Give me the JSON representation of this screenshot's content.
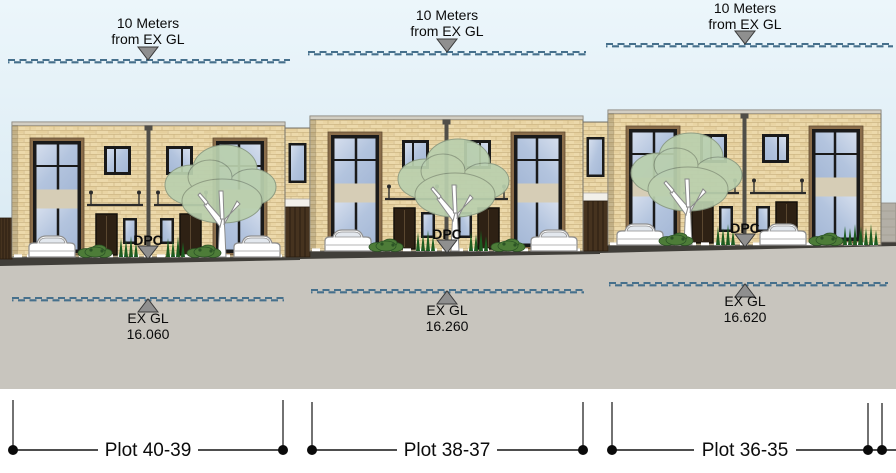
{
  "drawing": {
    "type": "street-elevation",
    "datum_label": {
      "line1": "10 Meters",
      "line2": "from EX GL"
    },
    "sections": [
      {
        "plot_label": "Plot 40-39",
        "dpc_label": "DPC",
        "exgl_label": "EX GL",
        "exgl_value": "16.060"
      },
      {
        "plot_label": "Plot 38-37",
        "dpc_label": "DPC",
        "exgl_label": "EX GL",
        "exgl_value": "16.260"
      },
      {
        "plot_label": "Plot 36-35",
        "dpc_label": "DPC",
        "exgl_label": "EX GL",
        "exgl_value": "16.620"
      }
    ],
    "icons": {
      "datum_marker": "triangle-down",
      "dpc_marker": "triangle-down",
      "level_marker": "triangle-up",
      "dimension_end": "filled-circle"
    },
    "colors": {
      "sky": "#e7f3fa",
      "ground": "#c8c5be",
      "road_strip": "#403e39",
      "brick": "#ecd9ab",
      "dashed_line": "#46708c",
      "foliage": "#bad0ae",
      "wood_fence": "#46331f",
      "marker_gray": "#8f8f8f"
    }
  }
}
